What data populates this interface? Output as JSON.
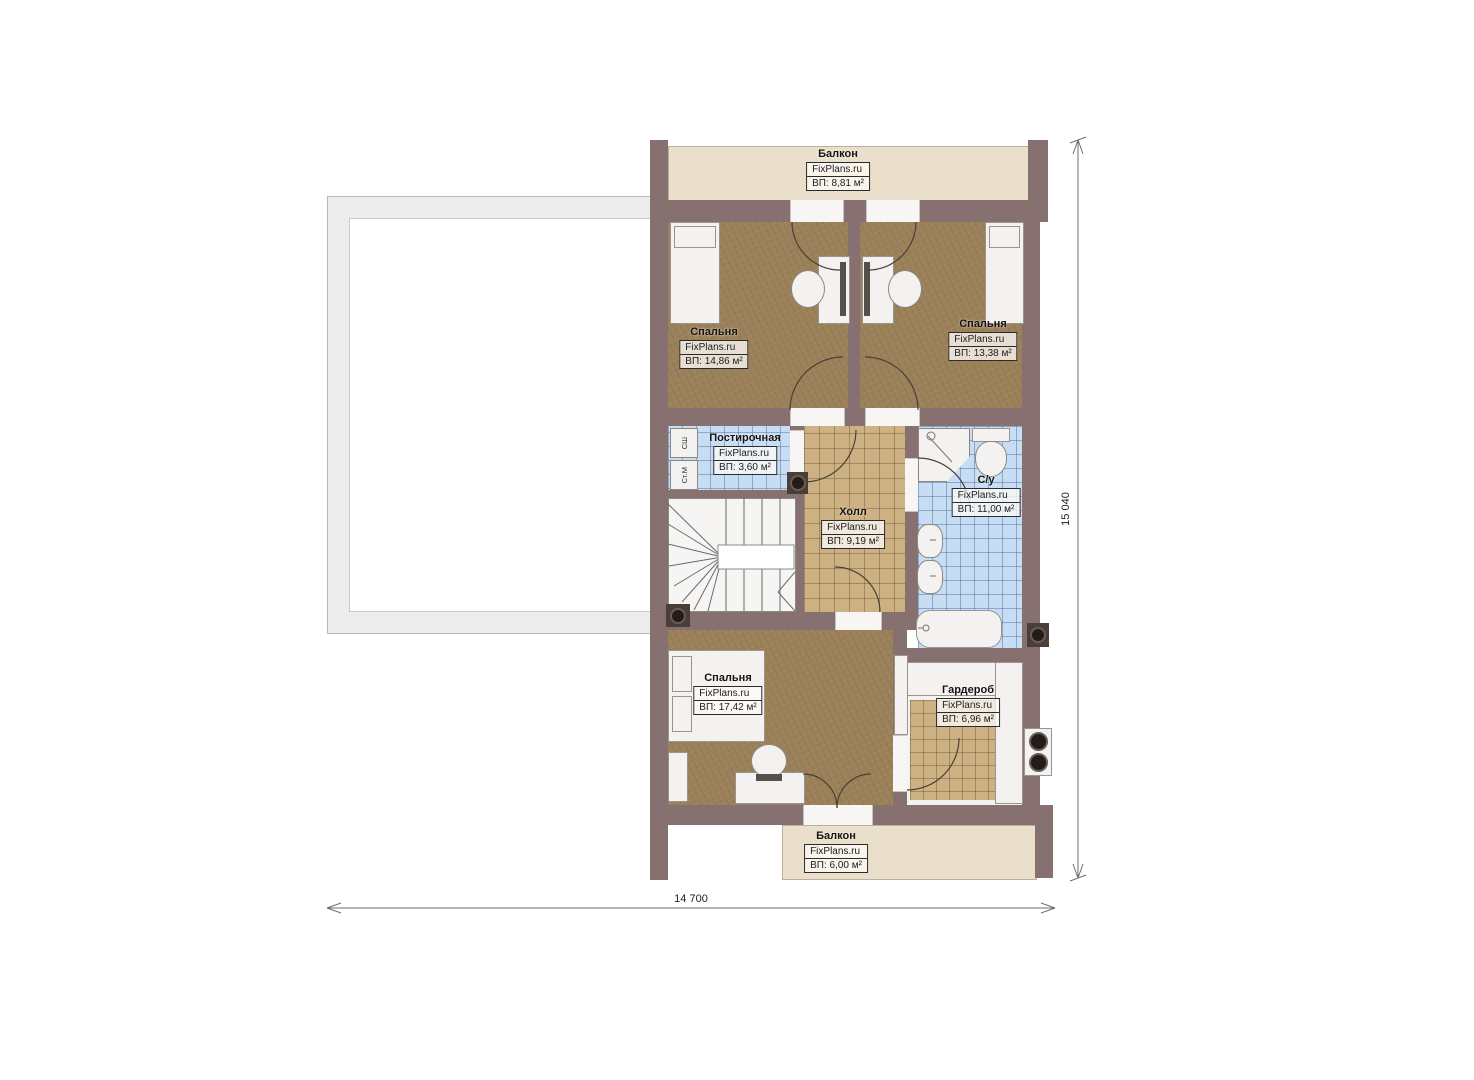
{
  "watermark": "FixPlans.ru",
  "rooms": {
    "balcony_top": {
      "name": "Балкон",
      "area": "ВП: 8,81 м²"
    },
    "bedroom_left": {
      "name": "Спальня",
      "area": "ВП: 14,86 м²"
    },
    "bedroom_right": {
      "name": "Спальня",
      "area": "ВП: 13,38 м²"
    },
    "laundry": {
      "name": "Постирочная",
      "area": "ВП: 3,60 м²"
    },
    "hall": {
      "name": "Холл",
      "area": "ВП: 9,19 м²"
    },
    "bathroom": {
      "name": "С/у",
      "area": "ВП: 11,00 м²"
    },
    "bedroom_bottom": {
      "name": "Спальня",
      "area": "ВП: 17,42 м²"
    },
    "wardrobe": {
      "name": "Гардероб",
      "area": "ВП: 6,96 м²"
    },
    "balcony_bottom": {
      "name": "Балкон",
      "area": "ВП: 6,00 м²"
    }
  },
  "appliances": {
    "dryer": "СШ",
    "washer": "Ст.М"
  },
  "dimensions": {
    "width": "14 700",
    "height": "15 040"
  },
  "colors": {
    "wall": "#877170",
    "floor_brown": "#9b8159",
    "tile_tan": "#cdb183",
    "tile_blue": "#c6ddf4",
    "balcony": "#eadfca",
    "furniture": "#f3f2f0",
    "line": "#5d564f"
  }
}
